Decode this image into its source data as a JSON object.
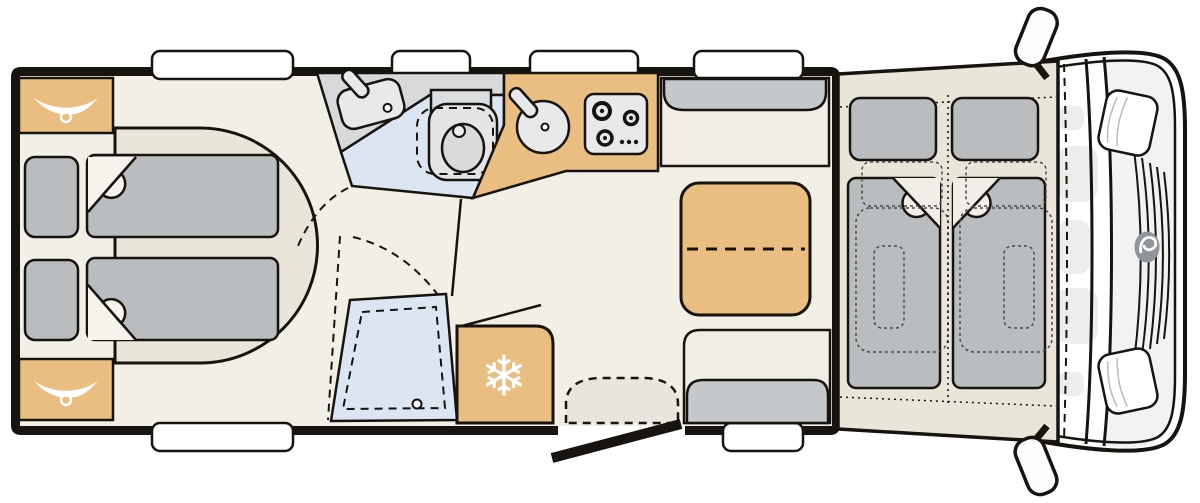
{
  "floorplan": {
    "glyphs": {
      "snowflake": "❄"
    },
    "colors": {
      "outline": "#17130e",
      "floor": "#f2efe6",
      "bed_base": "#e9e5d9",
      "upholstery": "#b9bdbf",
      "backrest": "#c5c8ca",
      "wood": "#eabd81",
      "washroom": "#d7d9db",
      "wet_area": "#dbe6f2",
      "appliance": "#e8e9ea",
      "cab_body": "#ffffff",
      "hood": "#f2f2f2",
      "cab_interior": "#ededed",
      "step": "#e8e5df",
      "logo_gray": "#8f9498",
      "window": "#ffffff"
    },
    "icons": [
      "hanger-icon",
      "snowflake-icon",
      "washbasin-icon",
      "toilet-icon",
      "kitchen-sink-icon",
      "hob-icon",
      "shower-drain-icon",
      "brand-logo",
      "steering-area",
      "mirror"
    ]
  }
}
